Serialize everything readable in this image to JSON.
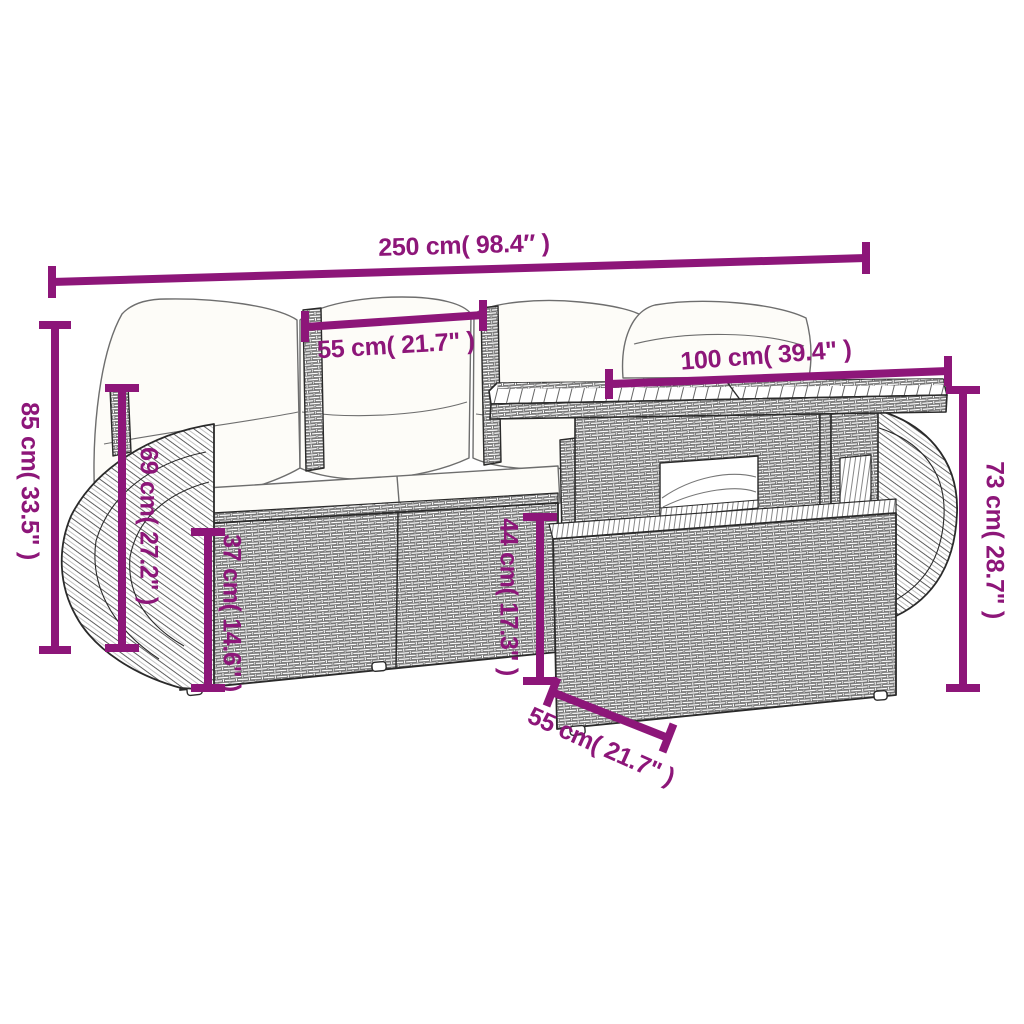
{
  "diagram": {
    "description": "Dimension diagram of a poly rattan garden lounge set: sofa with white cushions, curved side armrests and a two-tier table with slatted top",
    "colors": {
      "accent": "#8D1679",
      "outline": "#2a2a2a",
      "background": "#ffffff",
      "cushion_fill": "#fdfcf8"
    }
  },
  "dimensions": {
    "overall_width": "250 cm( 98.4″ )",
    "seat_width": "55 cm( 21.7\" )",
    "table_length": "100 cm( 39.4\" )",
    "overall_height": "85 cm( 33.5\" )",
    "back_height": "69 cm( 27.2\" )",
    "base_height": "37 cm( 14.6\" )",
    "seat_height": "44 cm( 17.3\" )",
    "table_height": "73 cm( 28.7\" )",
    "table_depth": "55 cm( 21.7\" )"
  }
}
